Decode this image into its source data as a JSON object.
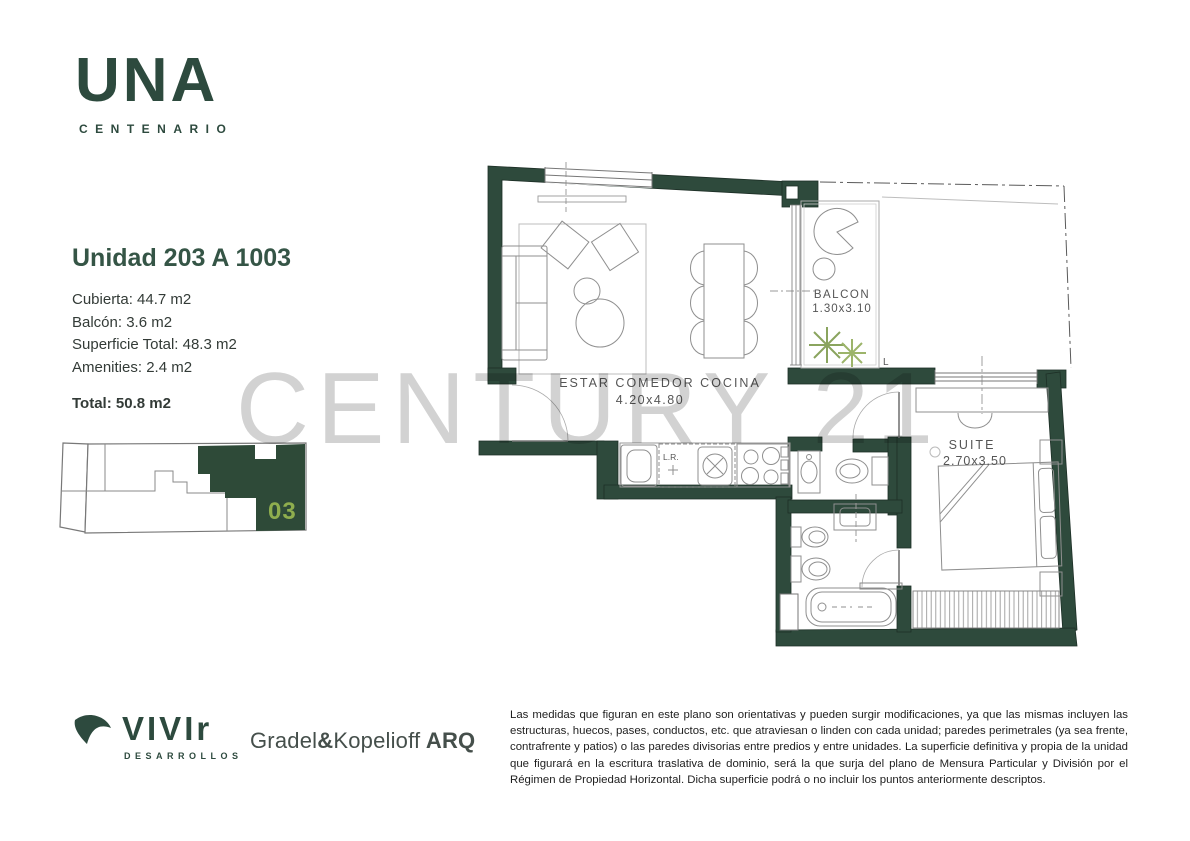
{
  "brand": {
    "logo_text": "UNA",
    "logo_subtext": "CENTENARIO"
  },
  "unit": {
    "title": "Unidad 203 A 1003",
    "details": [
      "Cubierta: 44.7 m2",
      "Balcón: 3.6 m2",
      "Superficie Total: 48.3 m2",
      "Amenities: 2.4 m2"
    ],
    "total": "Total: 50.8 m2"
  },
  "key_plan": {
    "unit_number": "03"
  },
  "floor_plan": {
    "rooms": [
      {
        "name": "ESTAR  COMEDOR  COCINA",
        "dimensions": "4.20x4.80"
      },
      {
        "name": "BALCON",
        "dimensions": "1.30x3.10"
      },
      {
        "name": "SUITE",
        "dimensions": "2.70x3.50"
      }
    ],
    "labels": {
      "laundry": "L.R.",
      "level_marker": "L"
    }
  },
  "watermark": "CENTURY 21",
  "footer": {
    "developer_name": "VIVIr",
    "developer_subtitle": "DESARROLLOS",
    "architect": {
      "part1": "Gradel",
      "amp": "&",
      "part2": "Kopelioff",
      "suffix": " ARQ"
    },
    "disclaimer": "Las medidas que figuran en este plano son orientativas y pueden surgir modificaciones, ya que las mismas incluyen las estructuras, huecos, pases, conductos, etc. que atraviesan o linden con cada unidad; paredes perimetrales (ya sea frente, contrafrente y patios) o las paredes divisorias entre predios y entre unidades. La superficie definitiva y propia de la unidad que figurará en la escritura traslativa de dominio, será la que surja del plano de Mensura Particular y División por el Régimen de Propiedad Horizontal. Dicha superficie podrá o no incluir los puntos anteriormente descriptos."
  },
  "colors": {
    "brand_green": "#2d4a3e",
    "wall_green": "#2e4a3c",
    "unit_highlight": "#8fae4e",
    "watermark_gray": "#d2d2d2"
  }
}
